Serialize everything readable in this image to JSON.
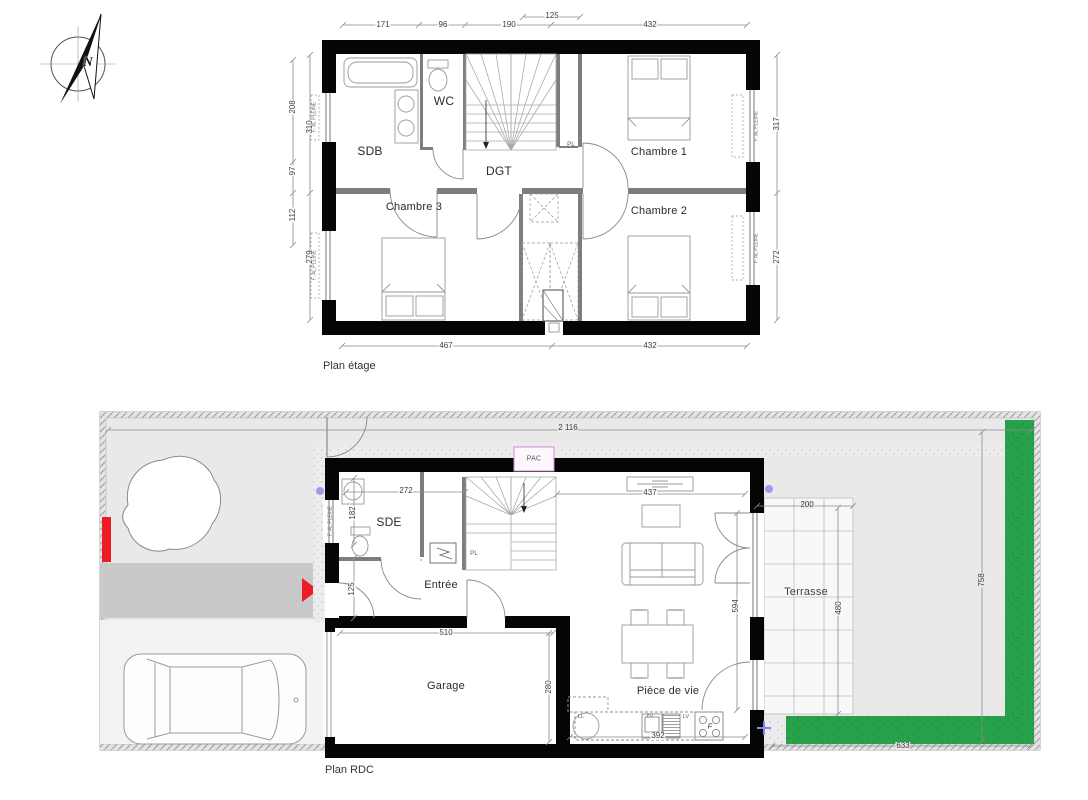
{
  "compass": {
    "letter": "N"
  },
  "etage": {
    "title": "Plan étage",
    "rooms": {
      "sdb": "SDB",
      "wc": "WC",
      "dgt": "DGT",
      "ch1": "Chambre 1",
      "ch2": "Chambre 2",
      "ch3": "Chambre 3"
    },
    "pl": "PL",
    "window_label": "F. AL PLEINE",
    "dims": {
      "d125": "125",
      "d171": "171",
      "d96": "96",
      "d190": "190",
      "d432t": "432",
      "d208": "208",
      "d310": "310",
      "d97": "97",
      "d112": "112",
      "d279": "279",
      "d317": "317",
      "d272": "272",
      "d467": "467",
      "d432b": "432"
    }
  },
  "rdc": {
    "title": "Plan RDC",
    "rooms": {
      "sde": "SDE",
      "entree": "Entrée",
      "garage": "Garage",
      "living": "Pièce de vie",
      "terrasse": "Terrasse"
    },
    "pl": "PL",
    "pac": "PAC",
    "window_label": "F. AL PLEINE",
    "kitchen": {
      "ll": "LL",
      "ev": "EV",
      "lv": "LV",
      "f": "F"
    },
    "dims": {
      "site_w": "2 116",
      "site_h": "758",
      "site_b": "633",
      "sde_w": "272",
      "sde_h": "182",
      "entry_h": "125",
      "liv_w": "437",
      "liv_h": "594",
      "gar_w": "510",
      "gar_h": "280",
      "kit_w": "392",
      "ter_w": "200",
      "ter_h": "480"
    }
  }
}
